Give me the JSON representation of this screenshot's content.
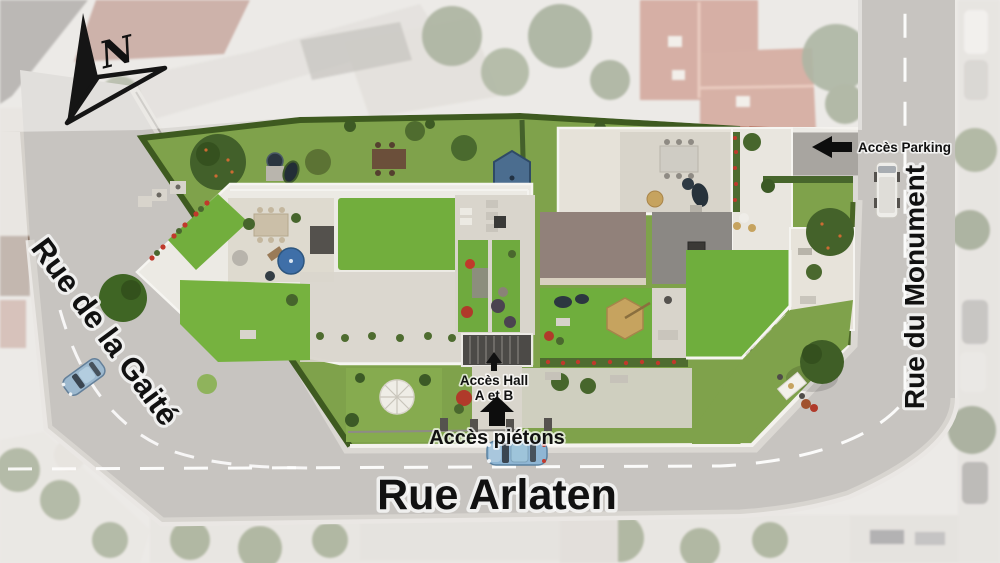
{
  "compass": {
    "north_label": "N"
  },
  "streets": {
    "gaite": {
      "name": "Rue de la Gaité"
    },
    "arlaten": {
      "name": "Rue Arlaten"
    },
    "monument": {
      "name": "Rue du Monument"
    }
  },
  "access_points": {
    "parking": {
      "label": "Accès Parking",
      "arrow_direction": "left"
    },
    "hall": {
      "label_line1": "Accès Hall",
      "label_line2": "A et B",
      "arrow_direction": "up"
    },
    "pedestrian": {
      "label": "Accès piétons",
      "arrow_direction": "up"
    }
  },
  "colors": {
    "road": "#c7c4c0",
    "sidewalk": "#dbd8d3",
    "road_marking": "#ffffff",
    "ground_lawn": "#7fa24b",
    "roof_lawn": "#72ae3d",
    "hedge": "#3e5a20",
    "deck_white": "#eceae4",
    "terrace_paver": "#d9d5cc",
    "roof_gray": "#8b8884",
    "roof_taupe": "#91817a",
    "roof_dark": "#54514d",
    "entrance_canopy": "#4c4a47",
    "label_text": "#111111",
    "parasol_blue": "#3f6fa8",
    "parasol_slate": "#4b6d8f",
    "parasol_tan": "#c6a35f",
    "flower_red": "#c0392b",
    "car_blue": "#8fb6d4",
    "context_red_roof": "#b06552"
  }
}
